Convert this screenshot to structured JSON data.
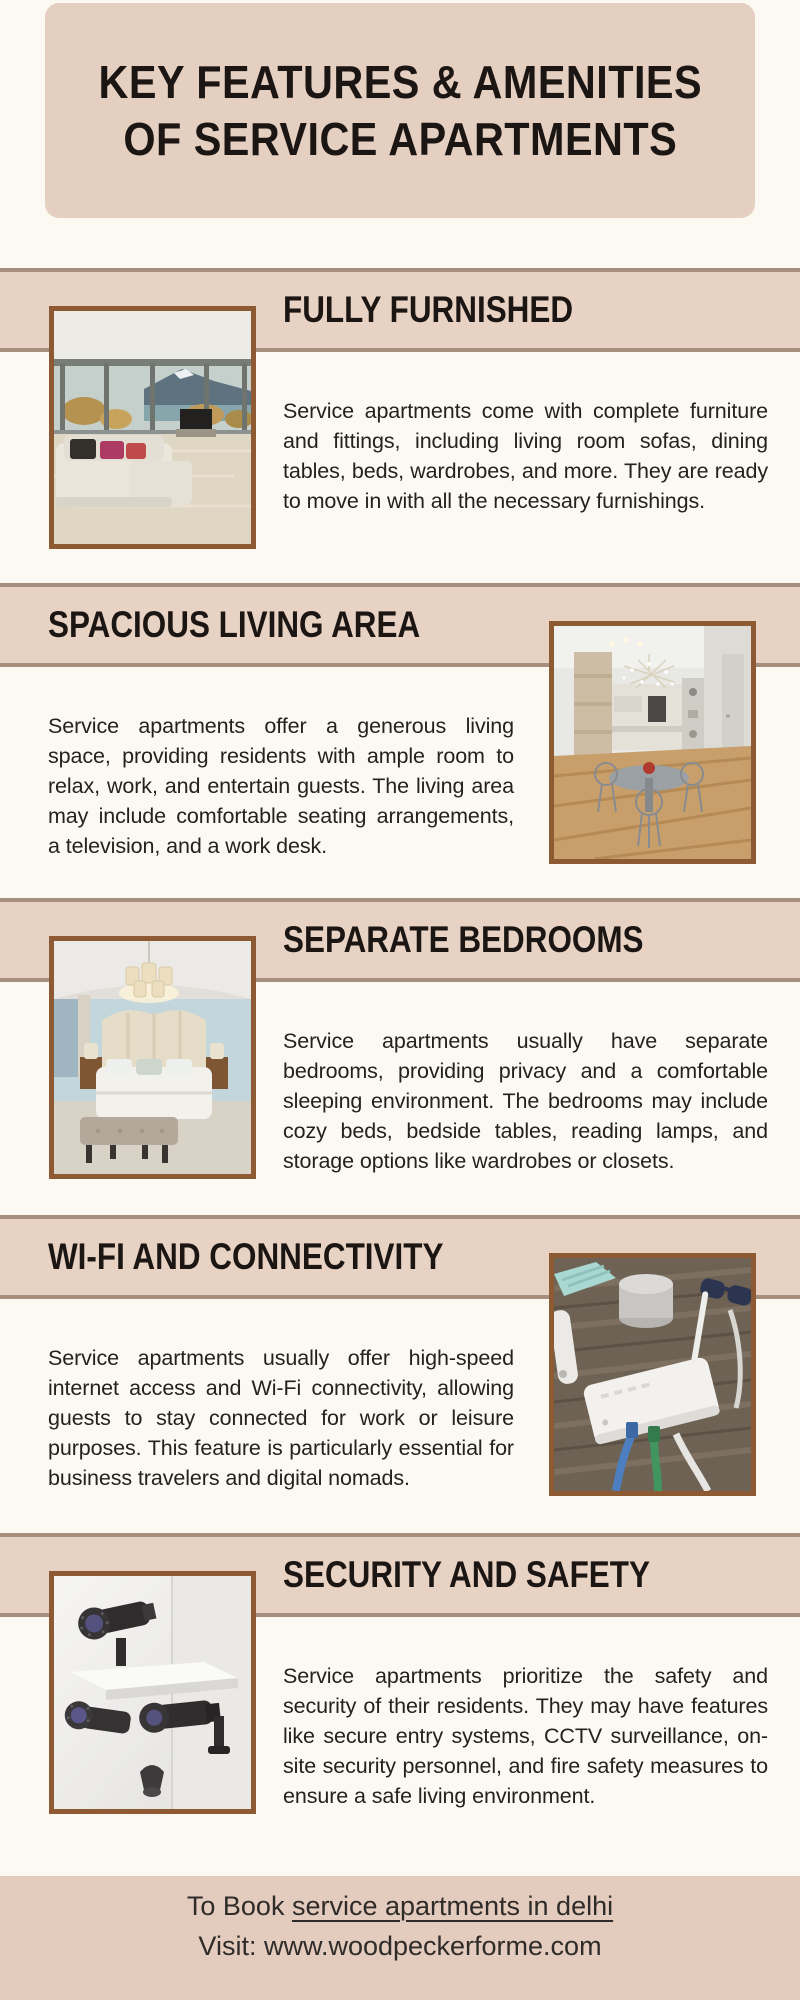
{
  "colors": {
    "page_background": "#fcf9f3",
    "panel_beige": "#e5cfc1",
    "band_beige": "#e8d2c3",
    "band_line": "#a78f7e",
    "photo_border": "#8e5a33",
    "text_dark": "#1b1613"
  },
  "header": {
    "title_line1": "KEY FEATURES & AMENITIES",
    "title_line2": "OF SERVICE APARTMENTS"
  },
  "sections": [
    {
      "title": "FULLY FURNISHED",
      "body": "Service apartments come with complete furniture and fittings, including living room sofas, dining tables, beds, wardrobes, and more. They are ready to move in with all the necessary furnishings.",
      "image_side": "left",
      "photo": "living-room-photo"
    },
    {
      "title": "SPACIOUS LIVING AREA",
      "body": "Service apartments offer a generous living space, providing residents with ample room to relax, work, and entertain guests. The living area may include comfortable seating arrangements, a television, and a work desk.",
      "image_side": "right",
      "photo": "dining-kitchen-photo"
    },
    {
      "title": "SEPARATE BEDROOMS",
      "body": "Service apartments usually have separate bedrooms, providing privacy and a comfortable sleeping environment. The bedrooms may include cozy beds, bedside tables, reading lamps, and storage options like wardrobes or closets.",
      "image_side": "left",
      "photo": "bedroom-photo"
    },
    {
      "title": "WI-FI AND CONNECTIVITY",
      "body": "Service apartments usually offer high-speed internet access and Wi-Fi connectivity, allowing guests to stay connected for work or leisure purposes. This feature is particularly essential for business travelers and digital nomads.",
      "image_side": "right",
      "photo": "wifi-router-photo"
    },
    {
      "title": "SECURITY AND SAFETY",
      "body": "Service apartments prioritize the safety and security of their residents. They may have features like secure entry systems, CCTV surveillance, on-site security personnel, and fire safety measures to ensure a safe living environment.",
      "image_side": "left",
      "photo": "cctv-cameras-photo"
    }
  ],
  "footer": {
    "line1_prefix": "To Book ",
    "line1_link": "service apartments in delhi",
    "line2": "Visit: www.woodpeckerforme.com"
  }
}
